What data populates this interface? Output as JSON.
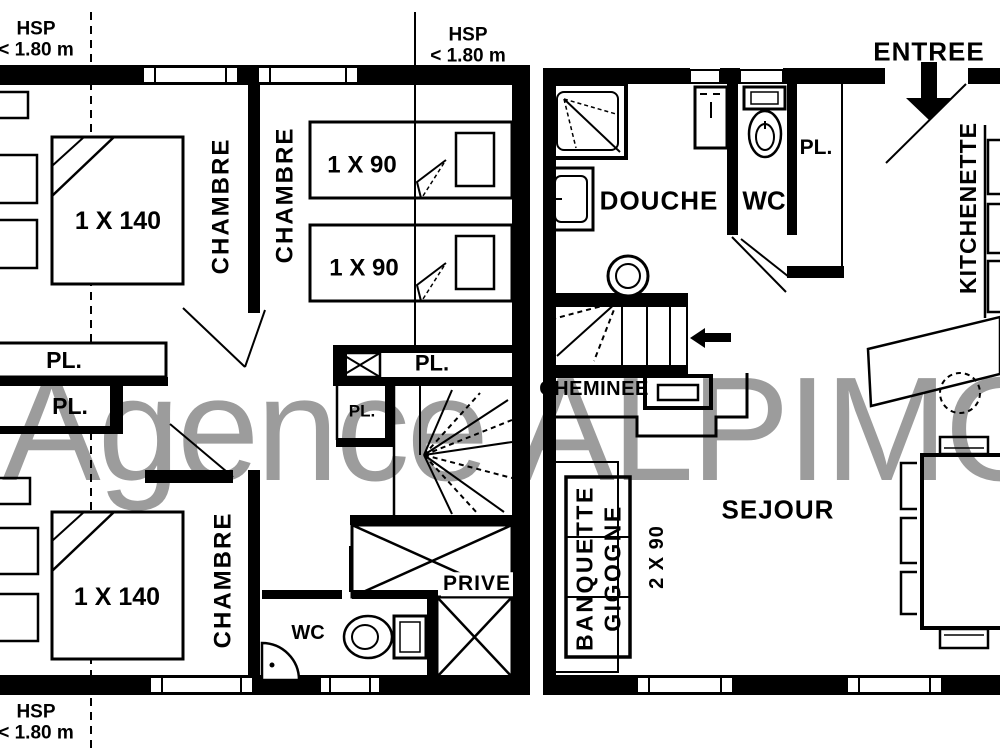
{
  "watermark": {
    "text": "Agence ALPIMO",
    "color": "#9c9c9c"
  },
  "upper_floor": {
    "hsp_top_left": {
      "title": "HSP",
      "value": "< 1.80 m"
    },
    "hsp_top_center": {
      "title": "HSP",
      "value": "< 1.80 m"
    },
    "hsp_bottom_left": {
      "title": "HSP",
      "value": "< 1.80 m"
    },
    "bedroom_top_left": {
      "name": "CHAMBRE",
      "bed": "1 X 140"
    },
    "bedroom_top_center": {
      "name": "CHAMBRE",
      "bed_top": "1 X 90",
      "bed_bottom": "1 X 90"
    },
    "bedroom_bottom_left": {
      "name": "CHAMBRE",
      "bed": "1 X 140"
    },
    "closet_left_1": "PL.",
    "closet_left_2": "PL.",
    "closet_center": "PL.",
    "closet_stairs": "PL.",
    "wc": "WC",
    "private_area": "PRIVE"
  },
  "ground_floor": {
    "entry": "ENTREE",
    "shower_room": "DOUCHE",
    "wc": "WC",
    "closet": "PL.",
    "kitchenette": "KITCHENETTE",
    "fireplace": "CHEMINEE",
    "living_room": "SEJOUR",
    "banquette": {
      "line1": "BANQUETTE",
      "line2": "GIGOGNE",
      "size": "2 X 90"
    }
  }
}
